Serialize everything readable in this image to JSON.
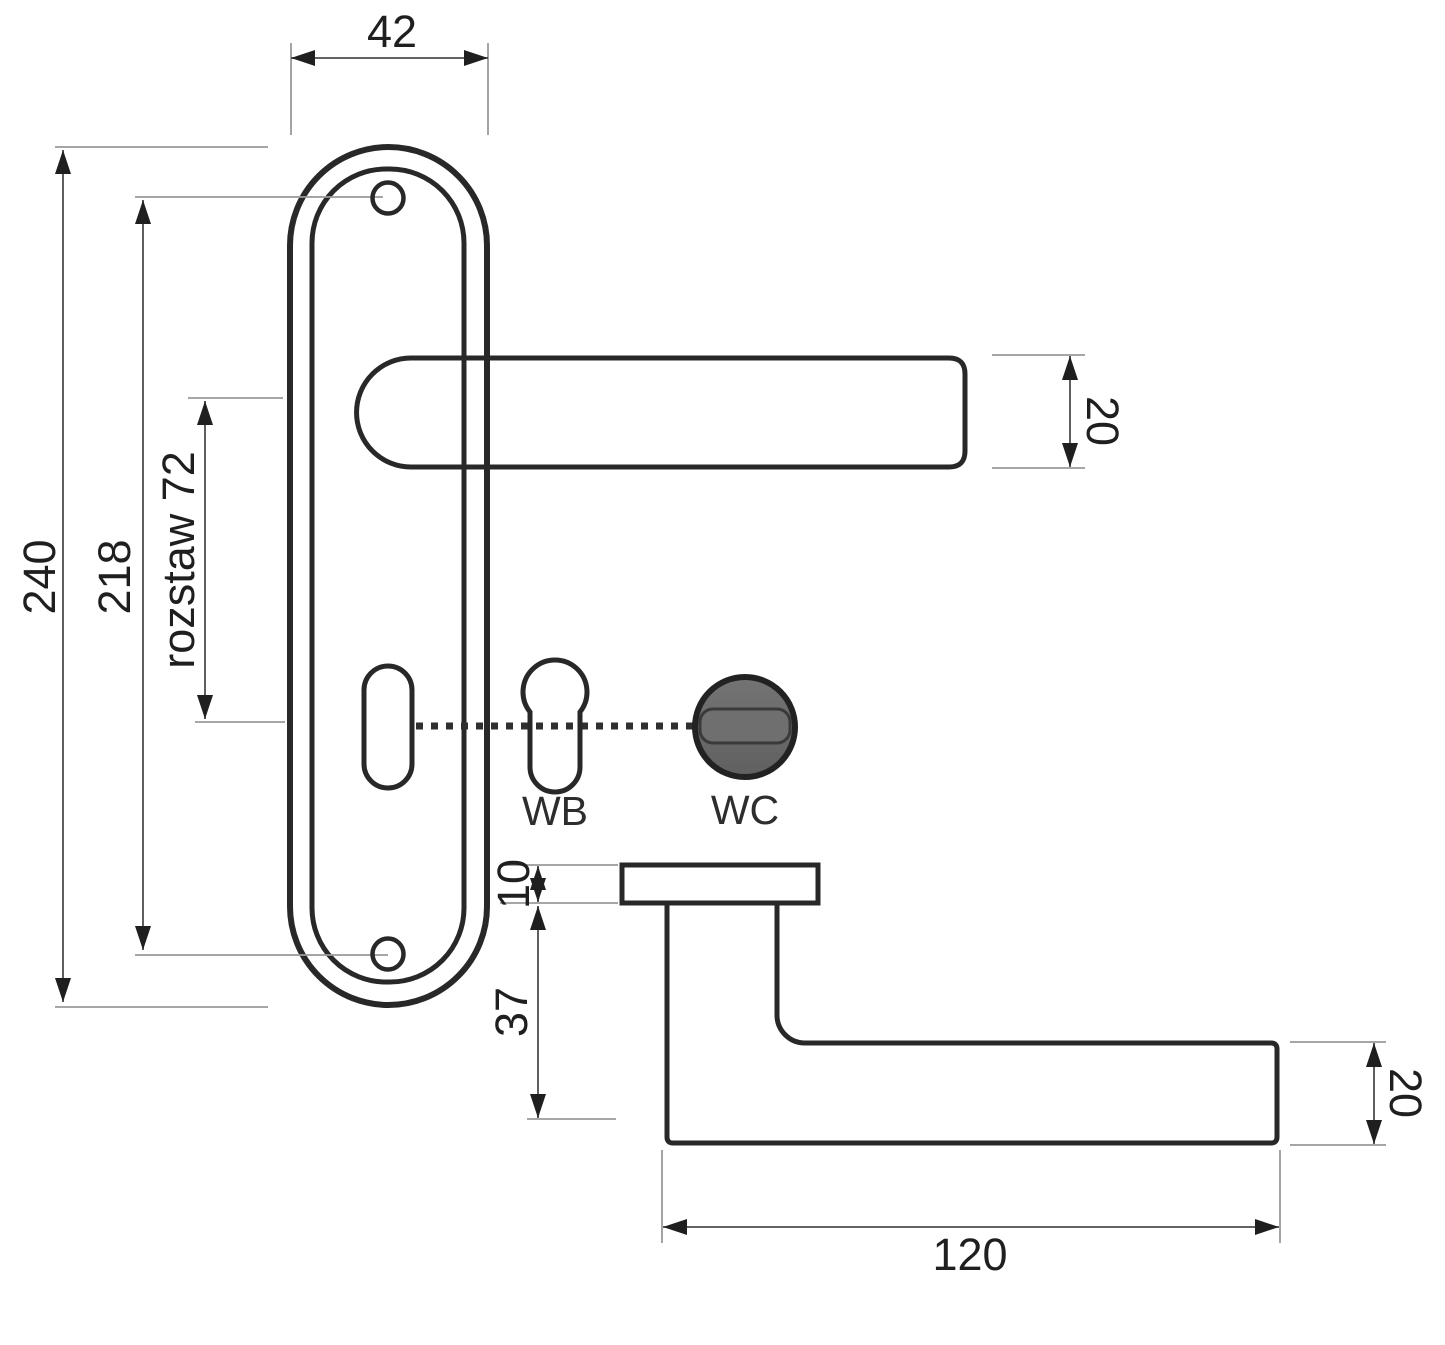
{
  "drawing": {
    "type": "door-handle-technical-drawing",
    "views": [
      "front",
      "side"
    ]
  },
  "front_view": {
    "dims": {
      "plate_width": "42",
      "total_height": "240",
      "screw_spacing": "218",
      "axis_spacing": "rozstaw 72",
      "lever_section": "20"
    },
    "variants": {
      "keyhole": "WK",
      "cylinder": "WB",
      "turn": "WC"
    }
  },
  "side_view": {
    "dims": {
      "rose_thickness": "10",
      "neck_depth": "37",
      "lever_section": "20",
      "lever_length": "120"
    }
  },
  "colors": {
    "background": "#ffffff",
    "outline": "#282828",
    "metal": "#6f6f6f",
    "metal_dark": "#545454",
    "wc_knob": "#6b6b6b",
    "slot": "#6f6f6f",
    "dim_line": "#4d4d4d",
    "ext_line": "#9a9a9a",
    "text": "#1f1f1f"
  }
}
